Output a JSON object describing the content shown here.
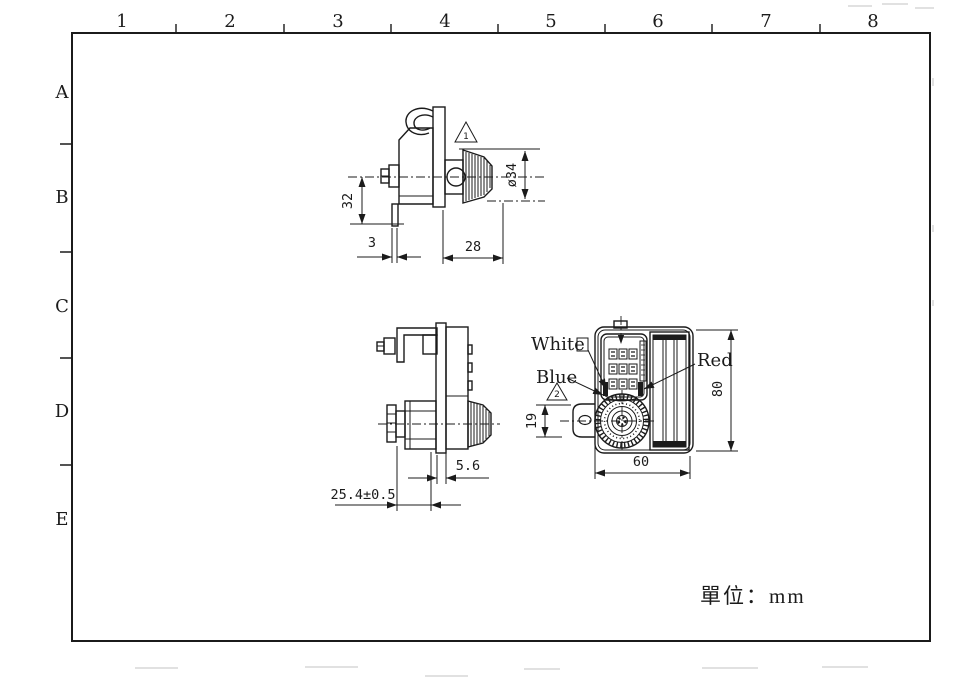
{
  "drawing": {
    "ink_color": "#1b1b1b",
    "unit_note": "單位：mm",
    "grid_columns": [
      "1",
      "2",
      "3",
      "4",
      "5",
      "6",
      "7",
      "8"
    ],
    "grid_rows": [
      "A",
      "B",
      "C",
      "D",
      "E"
    ],
    "side_view": {
      "dim_height": "32",
      "dim_latch_offset": "3",
      "dim_depth": "28",
      "dim_knob_diameter": "ø34",
      "note_ref": "1"
    },
    "profile_view": {
      "dim_cam_thickness": "5.6",
      "dim_grip_length": "25.4±0.5"
    },
    "front_view": {
      "label_white": "White",
      "label_blue": "Blue",
      "label_red": "Red",
      "dim_latch_height": "19",
      "dim_width": "60",
      "dim_height": "80",
      "note_ref": "2"
    }
  }
}
